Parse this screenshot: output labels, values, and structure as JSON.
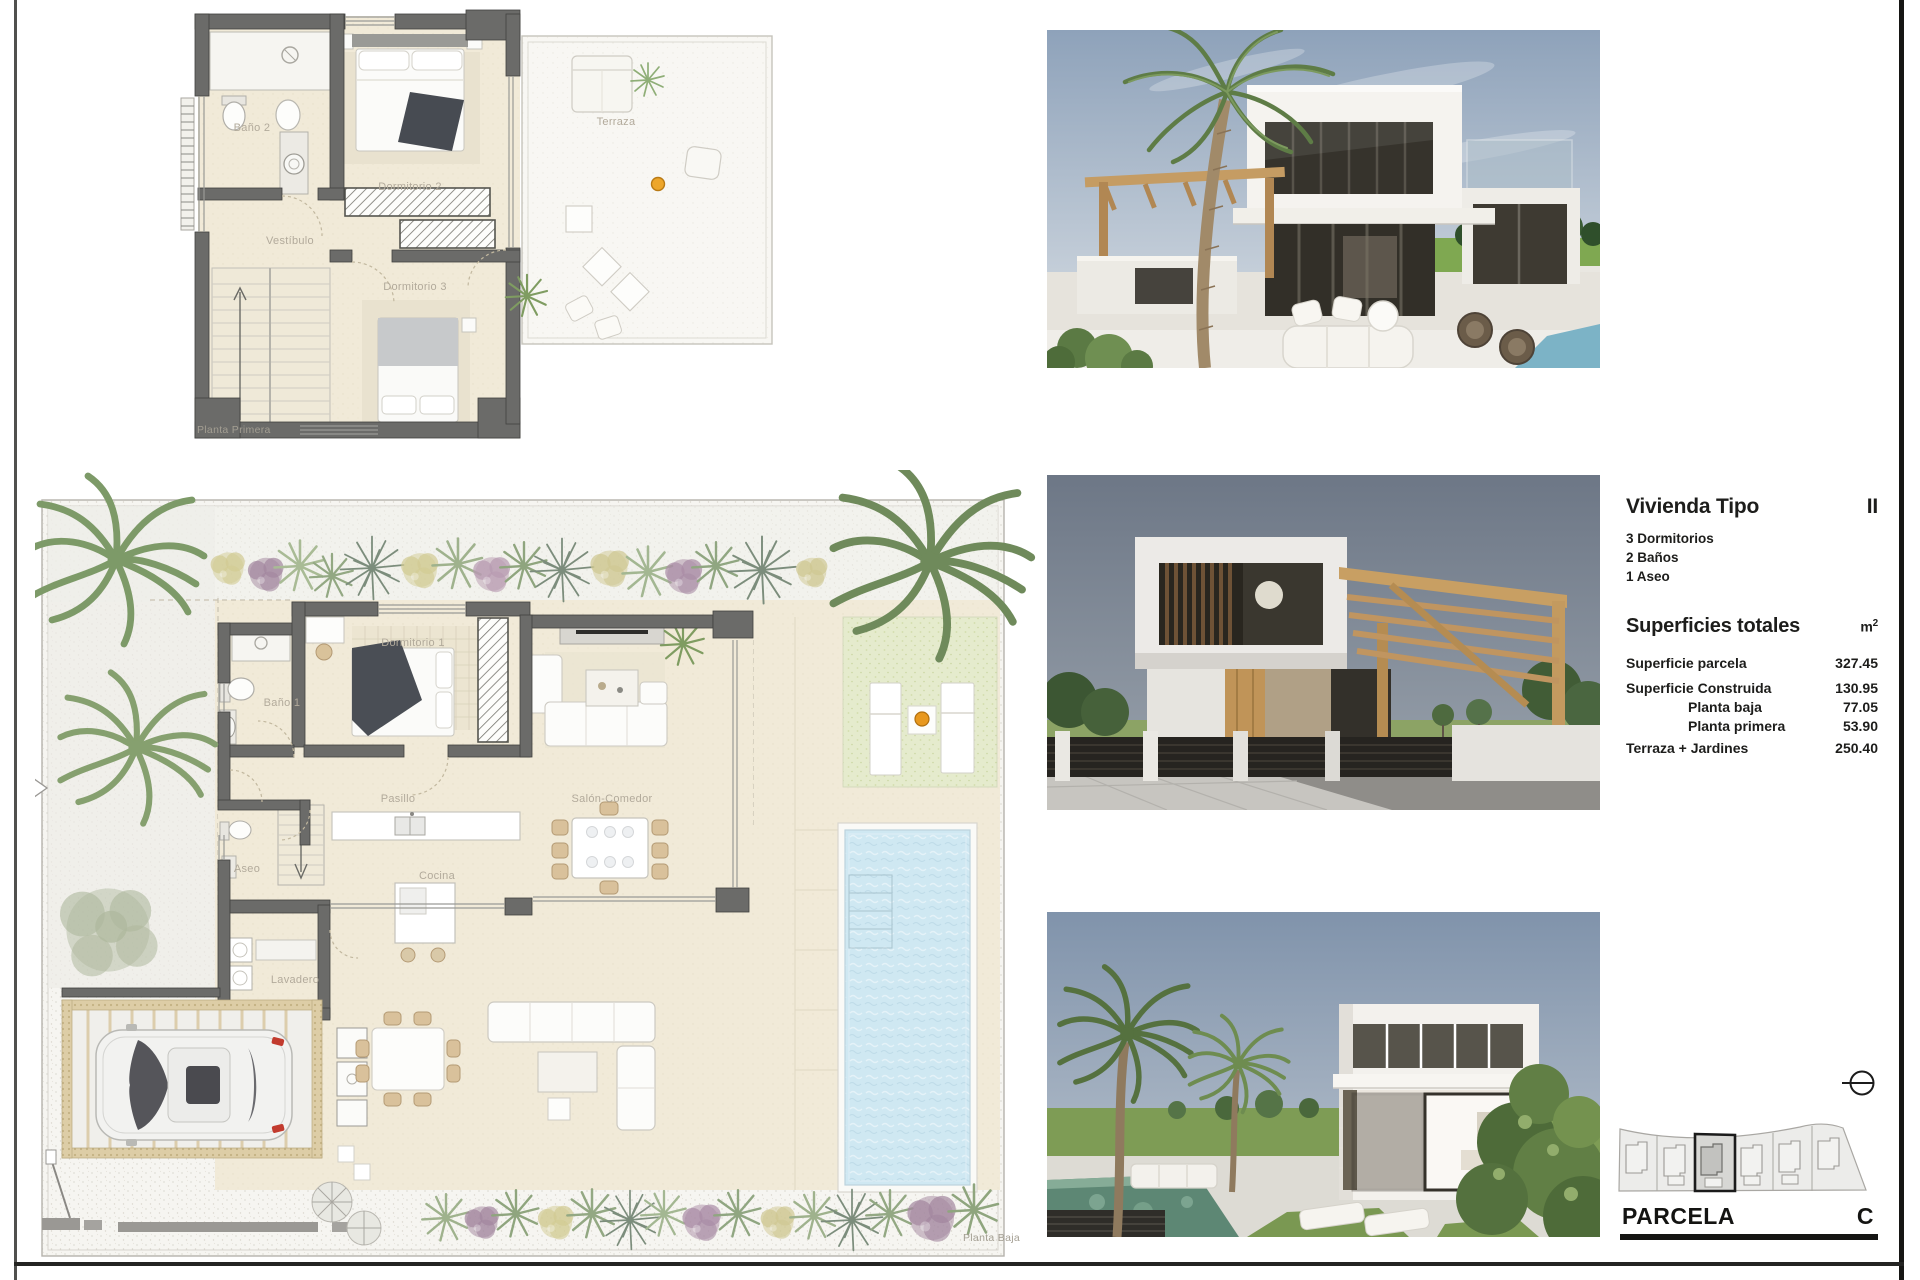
{
  "plan_upper": {
    "caption": "Planta Primera",
    "rooms": {
      "bano2": "Baño 2",
      "vestibulo": "Vestíbulo",
      "dormitorio2": "Dormitorio 2",
      "dormitorio3": "Dormitorio 3",
      "terraza": "Terraza"
    }
  },
  "plan_lower": {
    "caption": "Planta Baja",
    "rooms": {
      "bano1": "Baño 1",
      "dormitorio1": "Dormitorio 1",
      "pasillo": "Pasillo",
      "aseo": "Aseo",
      "cocina": "Cocina",
      "lavadero": "Lavadero",
      "salon": "Salón-Comedor"
    }
  },
  "info_panel": {
    "title": "Vivienda Tipo",
    "type_value": "II",
    "features": [
      "3 Dormitorios",
      "2 Baños",
      "1 Aseo"
    ],
    "surfaces_title": "Superficies totales",
    "unit": "m",
    "unit_sup": "2",
    "rows": [
      {
        "label": "Superficie parcela",
        "value": "327.45"
      },
      {
        "label": "Superficie Construida",
        "value": "130.95"
      },
      {
        "label": "Planta baja",
        "value": "77.05"
      },
      {
        "label": "Planta primera",
        "value": "53.90"
      },
      {
        "label": "Terraza + Jardines",
        "value": "250.40"
      }
    ]
  },
  "parcela": {
    "label": "PARCELA",
    "value": "C"
  },
  "renders": [
    {
      "name": "exterior-render-terrace-day"
    },
    {
      "name": "exterior-render-street-dusk"
    },
    {
      "name": "exterior-render-garden-pool"
    }
  ],
  "colors": {
    "wall_gray": "#6b6b69",
    "floor_beige": "#f1ead8",
    "terrace_white": "#f8f7f2",
    "pool_blue": "#cfe8f2",
    "lawn_green": "#e5ebcd",
    "pergola_tan": "#ddcda6",
    "accent_orange": "#e8981e",
    "text_dark": "#1d1d1b",
    "label_gray": "#b2aa9b"
  }
}
